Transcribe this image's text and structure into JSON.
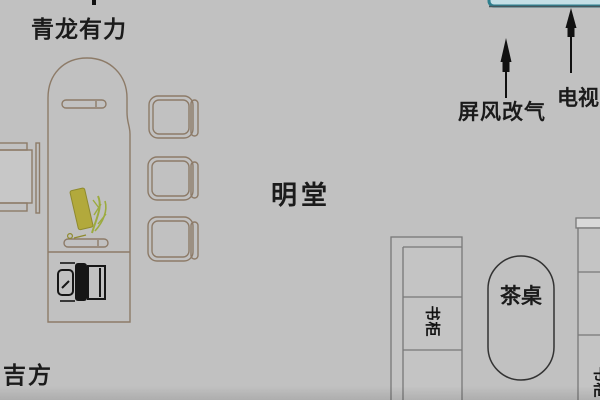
{
  "diagram": {
    "kind": "fengshui-office-floorplan",
    "background": "#c1c1c1"
  },
  "annotations": {
    "azure_dragon": "青龙有力",
    "ming_tang": "明堂",
    "auspicious_side": "吉方"
  },
  "arrows": [
    {
      "id": "screen-arrow",
      "label": "屏风改气",
      "direction": "up"
    },
    {
      "id": "tv-arrow",
      "label": "电视",
      "direction": "up"
    }
  ],
  "furniture": {
    "executive_desk": {
      "name": "executive-desk"
    },
    "desk_chair": {
      "name": "office-chair"
    },
    "side_chair": {
      "name": "side-chair"
    },
    "guest_chairs": {
      "name": "guest-chair",
      "count": 3
    },
    "tea_table": {
      "label": "茶桌"
    },
    "left_cabinet": {
      "label": "书柜"
    },
    "right_cabinet": {
      "label": "书柜"
    },
    "screen_tank": {
      "name": "screen-top-edge"
    }
  },
  "colors": {
    "background": "#c1c1c1",
    "furniture_outline": "#8d7b68",
    "cabinet_outline": "#787878",
    "ink": "#1b1b1b",
    "plant_olive": "#b2a93c",
    "plant_green": "#9cab40",
    "tank_border": "#2e7f8e",
    "tank_fill": "#c4dfe6"
  }
}
